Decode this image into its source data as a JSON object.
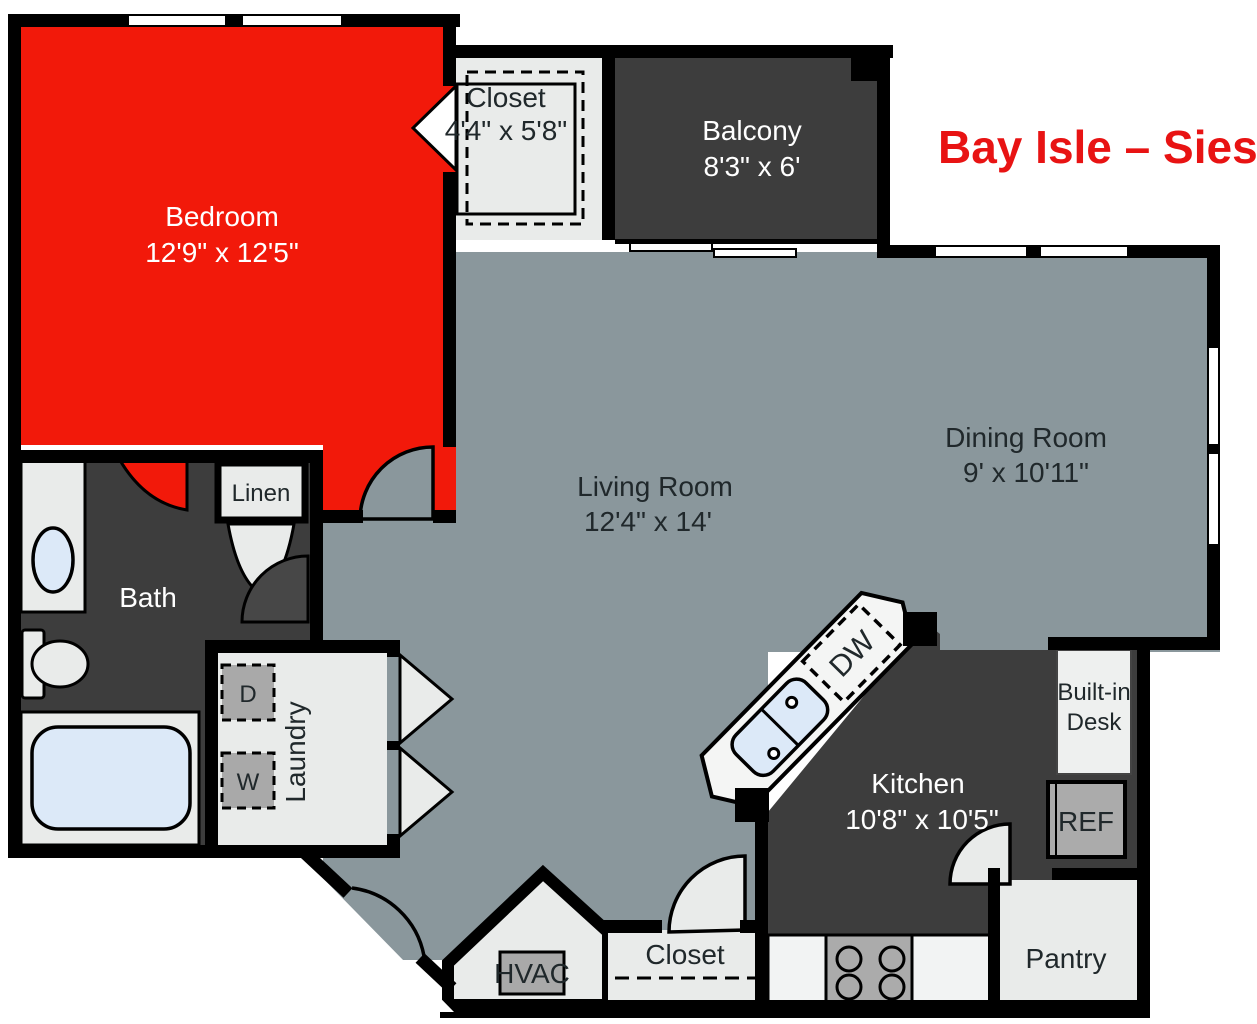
{
  "title": {
    "text": "Bay Isle – Siesta",
    "color": "#e81313"
  },
  "colors": {
    "background": "#ffffff",
    "floor_gray": "#8a979c",
    "highlight_red": "#f2190a",
    "dark_room": "#3d3d3d",
    "light_room": "#e9ebea",
    "appliance_gray": "#ababab",
    "fixture_blue": "#dce9f8",
    "wall_black": "#000000",
    "text_dark": "#20282b",
    "text_light": "#ffffff"
  },
  "rooms": {
    "bedroom": {
      "label": "Bedroom",
      "dims": "12'9\" x 12'5\""
    },
    "closet_top": {
      "label": "Closet",
      "dims": "4'4\" x 5'8\""
    },
    "balcony": {
      "label": "Balcony",
      "dims": "8'3\" x 6'"
    },
    "living_room": {
      "label": "Living Room",
      "dims": "12'4\" x 14'"
    },
    "dining_room": {
      "label": "Dining Room",
      "dims": "9' x 10'11\""
    },
    "kitchen": {
      "label": "Kitchen",
      "dims": "10'8\" x 10'5\""
    },
    "bath": {
      "label": "Bath"
    },
    "linen": {
      "label": "Linen"
    },
    "laundry": {
      "label": "Laundry"
    },
    "hvac": {
      "label": "HVAC"
    },
    "closet_bottom": {
      "label": "Closet"
    },
    "pantry": {
      "label": "Pantry"
    },
    "built_in_desk": {
      "line1": "Built-in",
      "line2": "Desk"
    }
  },
  "appliances": {
    "dryer": "D",
    "washer": "W",
    "dishwasher": "DW",
    "refrigerator": "REF"
  }
}
